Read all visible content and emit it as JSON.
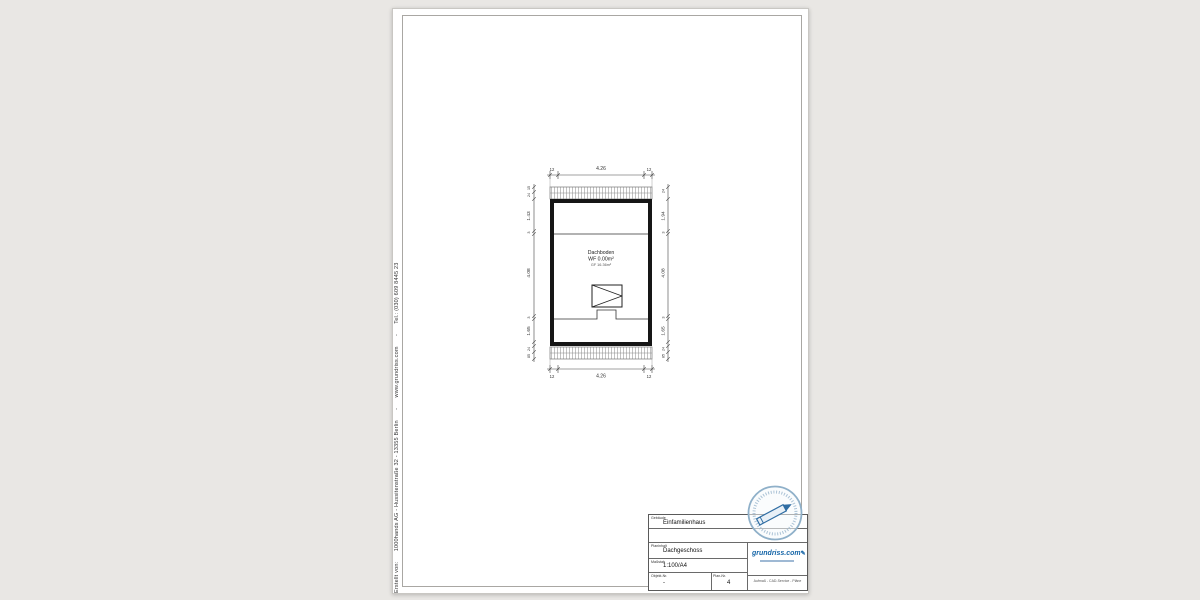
{
  "page": {
    "background": "#e9e7e4",
    "paper": "#ffffff"
  },
  "colors": {
    "wall": "#1a1a1a",
    "dimension": "#3a3a3a",
    "hatch": "#999999",
    "logo_blue": "#1565a7",
    "stamp_blue": "#8fb0c9"
  },
  "footer": {
    "credit_line": "Erstellt von:      1000hands AG - Hussitenstraße 32 - 13355 Berlin      -      www.grundriss.com      -      Tel.: (030) 609 8445 23"
  },
  "plan": {
    "room": {
      "name": "Dachboden",
      "area_wf": "WF 0.00m²",
      "area_gf": "GF 16.36m²"
    },
    "dims": {
      "top": [
        "12",
        "4.26",
        "12"
      ],
      "bottom": [
        "12",
        "4.26",
        "12"
      ],
      "left": [
        "15",
        "24",
        "1.43",
        "3",
        "4.08",
        "3",
        "1.65",
        "24",
        "85"
      ],
      "right": [
        "24",
        "1.94",
        "3",
        "4.08",
        "3",
        "1.65",
        "24",
        "85"
      ]
    }
  },
  "titleblock": {
    "building_label": "Gebäude",
    "building_value": "Einfamilienhaus",
    "content_label": "Planinhalt",
    "content_value": "Dachgeschoss",
    "scale_label": "Maßstab",
    "scale_value": "1:100/A4",
    "object_label": "Objekt-Nr.",
    "object_value": "-",
    "plannr_label": "Plan-Nr.",
    "plannr_value": "4",
    "logo_text": "grundriss.com",
    "pencil_icon": "✎",
    "services_line": "Aufmaß - CAD-Service - Pläne"
  }
}
